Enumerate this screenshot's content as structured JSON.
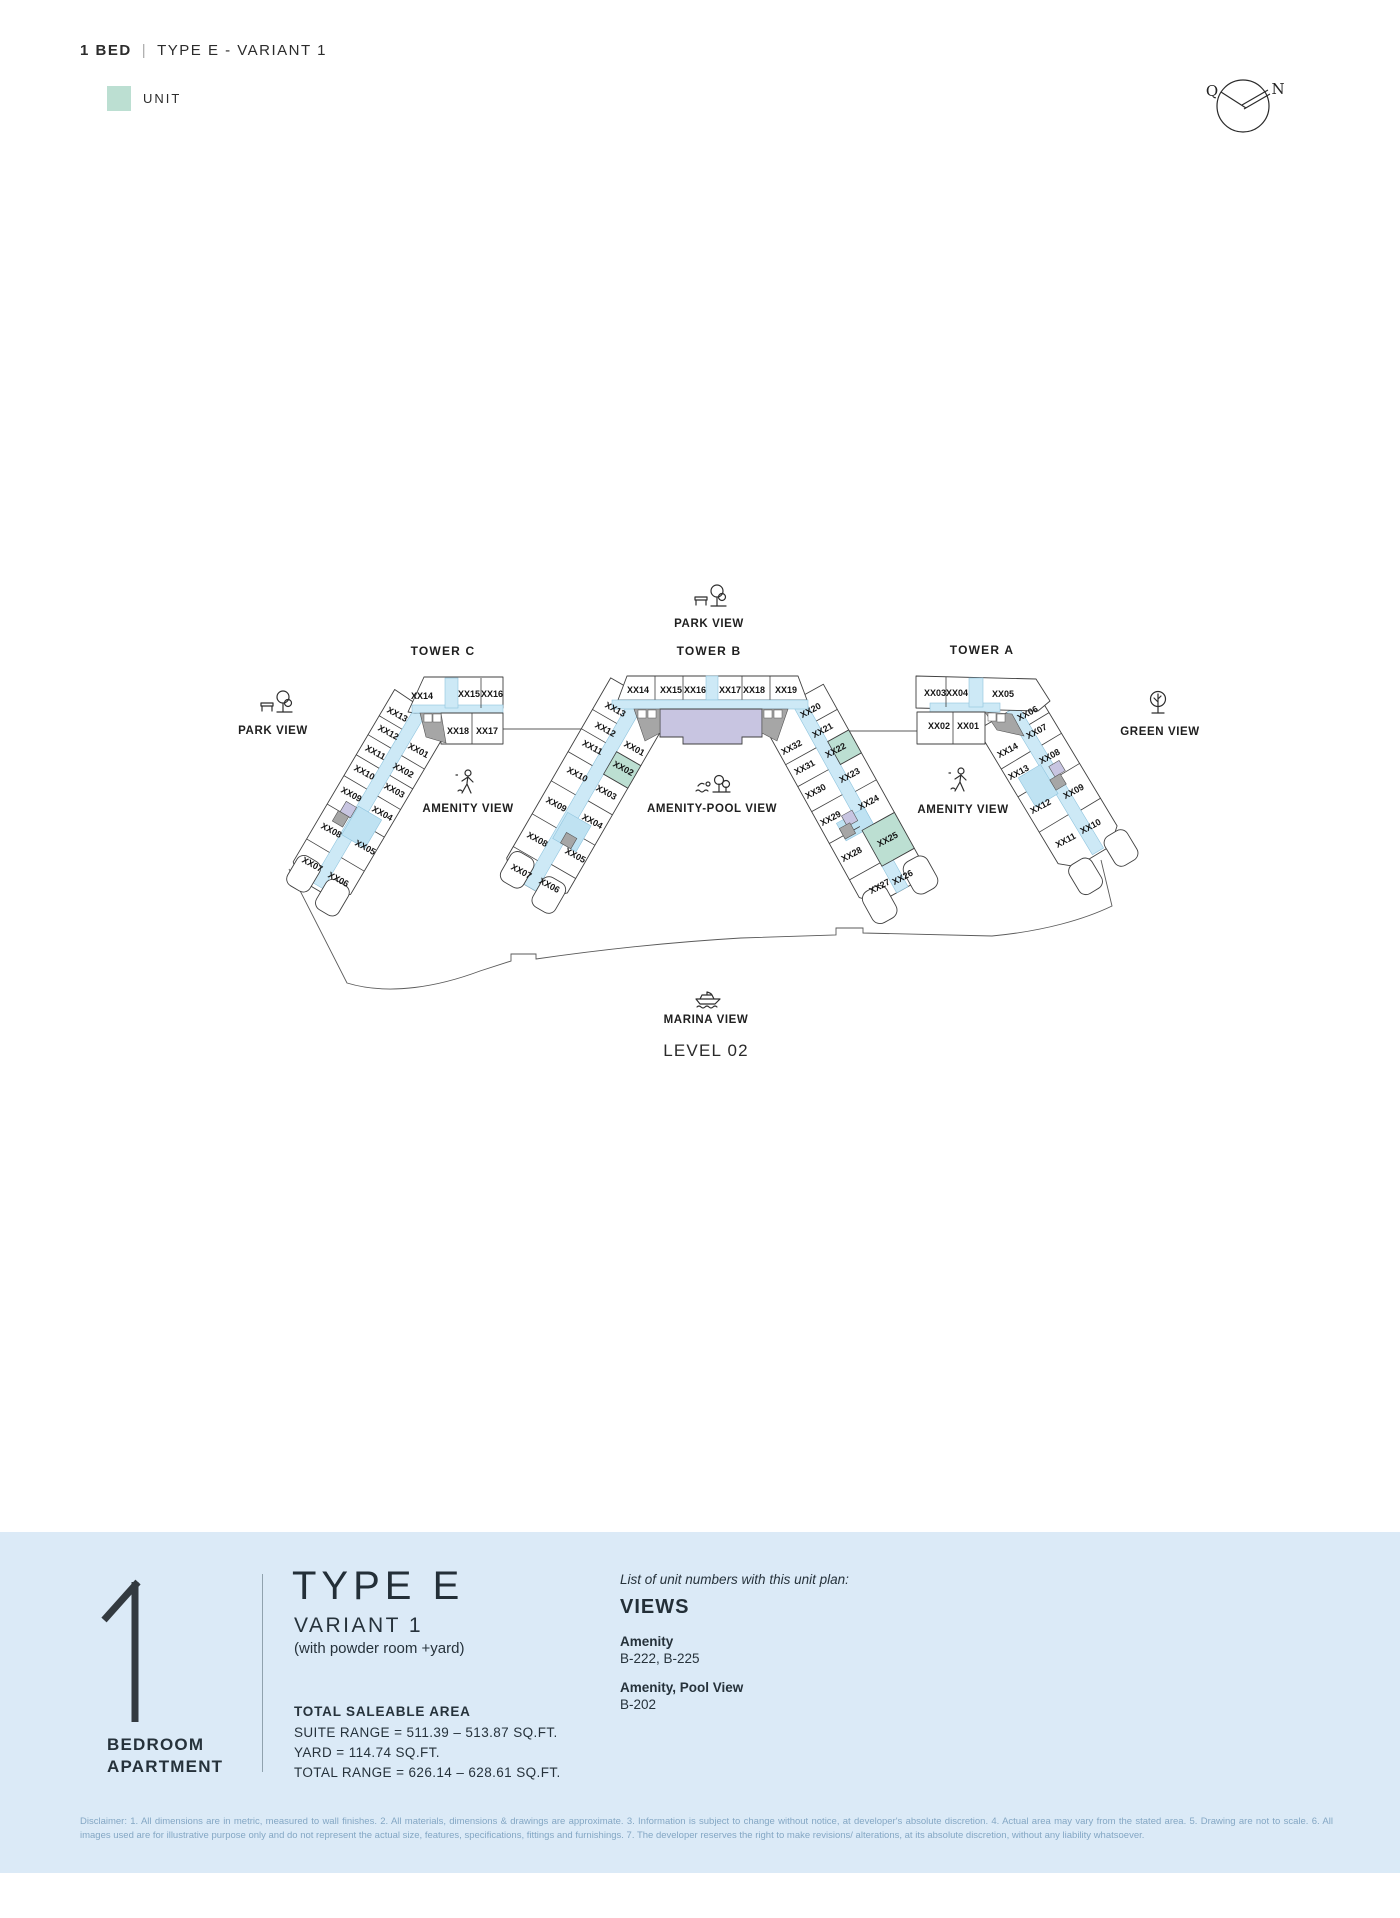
{
  "header": {
    "bold": "1 BED",
    "separator": "|",
    "rest": "TYPE E - VARIANT 1"
  },
  "legend": {
    "label": "UNIT"
  },
  "compass": {
    "qibla_label": "Q",
    "north_label": "N"
  },
  "colors": {
    "unit_highlight": "#bcdfd2",
    "corridor": "#cde9f6",
    "core": "#bfe2f2",
    "lavender": "#c8c5e1",
    "grey": "#a6a6a6",
    "panel_bg": "#dbeaf7"
  },
  "plan": {
    "level": "LEVEL 02",
    "towers": {
      "c": "TOWER C",
      "b": "TOWER B",
      "a": "TOWER A"
    },
    "views": {
      "park_left": "PARK VIEW",
      "park_top": "PARK VIEW",
      "amenity_left": "AMENITY VIEW",
      "amenity_pool": "AMENITY-POOL VIEW",
      "amenity_right": "AMENITY VIEW",
      "green": "GREEN VIEW",
      "marina": "MARINA VIEW"
    },
    "tower_c": {
      "top": [
        "XX14",
        "XX15",
        "XX16",
        "XX18",
        "XX17"
      ],
      "outer": [
        "XX13",
        "XX12",
        "XX11",
        "XX10",
        "XX09",
        "XX08",
        "XX07"
      ],
      "inner": [
        "XX01",
        "XX02",
        "XX03",
        "XX04",
        "XX05",
        "XX06"
      ]
    },
    "tower_b": {
      "top": [
        "XX14",
        "XX15",
        "XX16",
        "XX17",
        "XX18",
        "XX19"
      ],
      "left_outer": [
        "XX13",
        "XX12",
        "XX11",
        "XX10",
        "XX09",
        "XX08",
        "XX07"
      ],
      "left_inner": [
        "XX01",
        "XX02",
        "XX03",
        "XX04",
        "XX05",
        "XX06"
      ],
      "right_outer": [
        "XX20",
        "XX21",
        "XX22",
        "XX23",
        "XX24",
        "XX25",
        "XX26"
      ],
      "right_inner": [
        "XX32",
        "XX31",
        "XX30",
        "XX29",
        "XX28",
        "XX27"
      ]
    },
    "tower_a": {
      "top": [
        "XX03",
        "XX04",
        "XX05",
        "XX02",
        "XX01"
      ],
      "outer": [
        "XX06",
        "XX07",
        "XX08",
        "XX09",
        "XX10"
      ],
      "inner": [
        "XX14",
        "XX13",
        "XX12",
        "XX11"
      ]
    }
  },
  "panel": {
    "big_number": "1",
    "apartment_line1": "BEDROOM",
    "apartment_line2": "APARTMENT",
    "type_title": "TYPE E",
    "variant": "VARIANT 1",
    "variant_note": "(with powder room +yard)",
    "area_heading": "TOTAL SALEABLE AREA",
    "area_lines": [
      "SUITE RANGE = 511.39 – 513.87 SQ.FT.",
      "YARD = 114.74 SQ.FT.",
      "TOTAL RANGE = 626.14 – 628.61 SQ.FT."
    ],
    "list_intro": "List of unit numbers with this unit plan:",
    "views_heading": "VIEWS",
    "view_groups": [
      {
        "label": "Amenity",
        "units": "B-222, B-225"
      },
      {
        "label": "Amenity, Pool View",
        "units": "B-202"
      }
    ]
  },
  "disclaimer": "Disclaimer: 1. All dimensions are in metric, measured to wall finishes. 2. All materials, dimensions & drawings are approximate. 3. Information is subject to change without notice, at developer's absolute discretion. 4. Actual area may vary from the stated area. 5. Drawing are not to scale. 6. All images used are for illustrative purpose only and do not represent the actual size, features, specifications, fittings and furnishings. 7. The developer reserves the right to make revisions/ alterations, at its absolute discretion, without any liability whatsoever."
}
